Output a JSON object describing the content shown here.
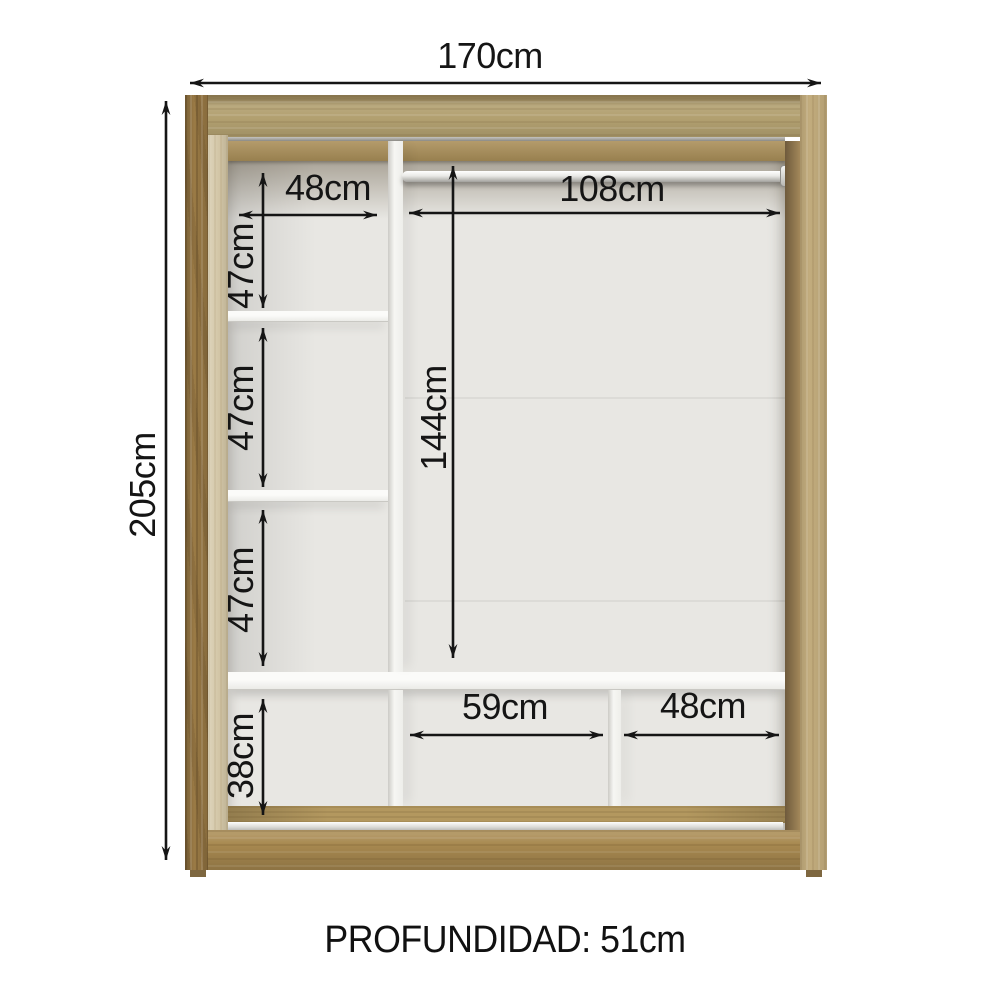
{
  "diagram": {
    "product": "wardrobe-interior-dimension-diagram",
    "depth_label": "PROFUNDIDAD: 51cm",
    "dims": {
      "total_width": "170cm",
      "total_height": "205cm",
      "left_column_width": "48cm",
      "rod_span_width": "108cm",
      "left_gap_top": "47cm",
      "left_gap_middle": "47cm",
      "left_gap_lower": "47cm",
      "hanging_section_height": "144cm",
      "bottom_row_height": "38cm",
      "bottom_middle_width": "59cm",
      "bottom_right_width": "48cm"
    },
    "colors": {
      "frame_wood": "#b2a070",
      "side_wood_dark": "#9a7a45",
      "side_wood_light": "#c2ac7d",
      "interior_back": "#e8e7e3",
      "shelf_white": "#f6f6f3",
      "dimension_line": "#151515",
      "floor_track_silver": "#d8d7d3"
    }
  }
}
